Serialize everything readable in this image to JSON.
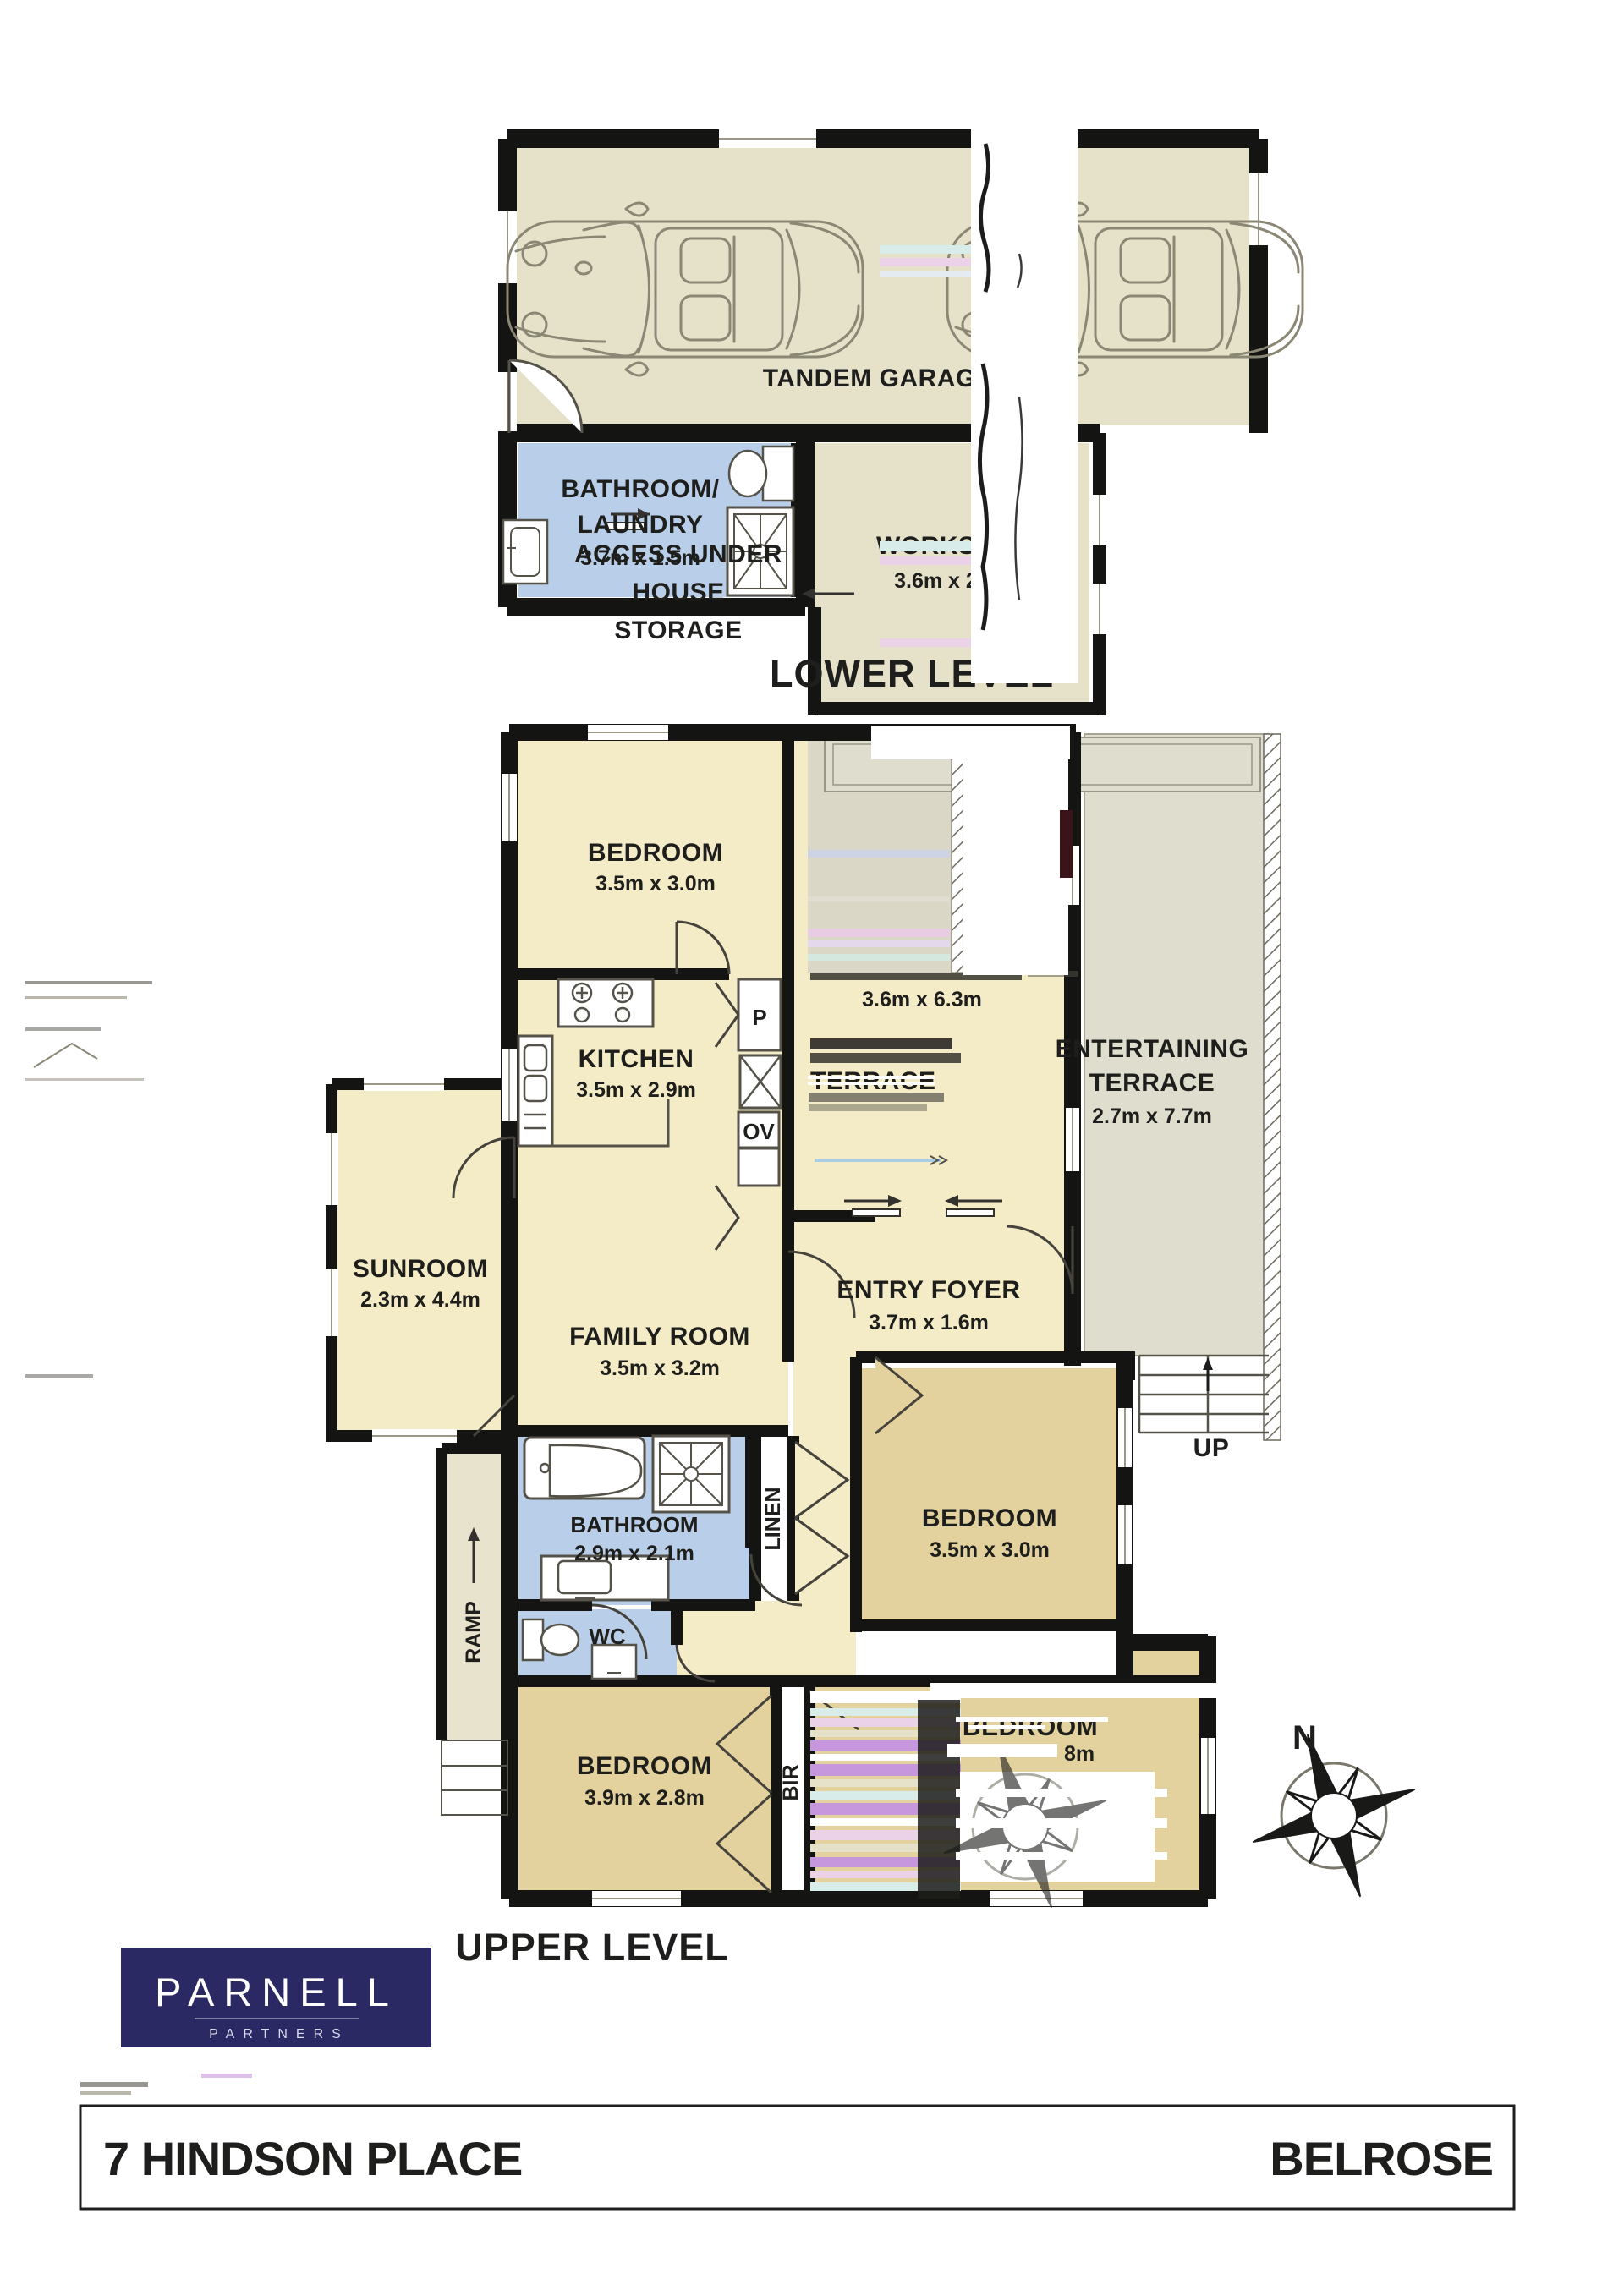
{
  "colors": {
    "wall": "#141413",
    "floor_beige": "#e6e2c9",
    "floor_yellow": "#f3ecc6",
    "floor_tan": "#e3d29d",
    "floor_blue": "#b9cfe9",
    "terrace_grey": "#dfddcd",
    "ramp_beige": "#e8e3cd",
    "logo_navy": "#2b2963",
    "glitch_pink": "#ecd2e8",
    "glitch_purple": "#c797dd",
    "glitch_cyan": "#d8ecea"
  },
  "lower_level": {
    "title": "LOWER LEVEL",
    "garage": {
      "name": "TANDEM GARAGE"
    },
    "bathroom_laundry": {
      "name_line1": "BATHROOM/",
      "name_line2": "LAUNDRY",
      "dims": "3.7m x 1.5m"
    },
    "workshop": {
      "name": "WORKSHOP",
      "dims": "3.6m x 2.5m"
    },
    "storage_note": {
      "line1": "ACCESS UNDER",
      "line2": "HOUSE",
      "line3": "STORAGE"
    }
  },
  "upper_level": {
    "title": "UPPER LEVEL",
    "bedroom_top": {
      "name": "BEDROOM",
      "dims": "3.5m x 3.0m"
    },
    "kitchen": {
      "name": "KITCHEN",
      "dims": "3.5m x 2.9m",
      "pantry": "P",
      "oven": "OV"
    },
    "lounge_dining": {
      "dims": "3.6m x 6.3m",
      "glitch_label": "TERRACE"
    },
    "entertaining_terrace": {
      "name_line1": "ENTERTAINING",
      "name_line2": "TERRACE",
      "dims": "2.7m x 7.7m"
    },
    "sunroom": {
      "name": "SUNROOM",
      "dims": "2.3m x 4.4m"
    },
    "family_room": {
      "name": "FAMILY ROOM",
      "dims": "3.5m x 3.2m"
    },
    "entry_foyer": {
      "name": "ENTRY FOYER",
      "dims": "3.7m x 1.6m"
    },
    "bedroom_mid": {
      "name": "BEDROOM",
      "dims": "3.5m x 3.0m"
    },
    "bathroom": {
      "name": "BATHROOM",
      "dims": "2.9m x 2.1m"
    },
    "linen": "LINEN",
    "wc": "WC",
    "ramp": "RAMP",
    "bedroom_left": {
      "name": "BEDROOM",
      "dims": "3.9m x 2.8m"
    },
    "bir": "BIR",
    "bedroom_right": {
      "name": "BEDROOM",
      "dims_fragment": "8m"
    },
    "up": "UP",
    "compass_n": "N"
  },
  "logo": {
    "brand": "PARNELL",
    "sub": "PARTNERS"
  },
  "footer": {
    "address": "7 HINDSON PLACE",
    "suburb": "BELROSE"
  }
}
